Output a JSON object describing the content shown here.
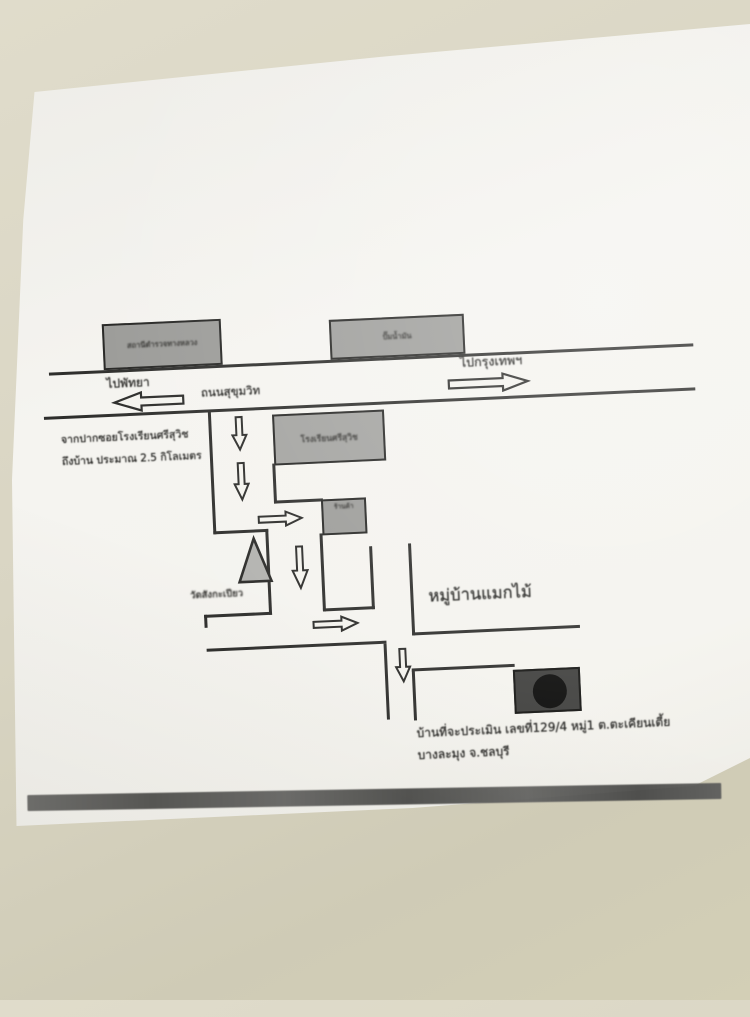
{
  "photo": {
    "surface": "desk",
    "background_color": "#d9d5c3",
    "paper_color": "#f4f3ee",
    "ink_color": "#2e2e2c"
  },
  "map": {
    "kind": "hand-drawn directions sketch (Thai)",
    "road": {
      "name_label": "ถนนสุขุมวิท",
      "left_direction_label": "ไปพัทยา",
      "right_direction_label": "ไปกรุงเทพฯ"
    },
    "buildings": [
      {
        "label": "สถานีตำรวจทางหลวง"
      },
      {
        "label": "ปั๊มน้ำมัน"
      }
    ],
    "school_label": "โรงเรียนศรีสุวิช",
    "shop_label": "ร้านค้า",
    "temple_label": "วัดสังกะเปียว",
    "village_label": "หมู่บ้านแมกไม้",
    "note_lines": [
      "จากปากซอยโรงเรียนศรีสุวิช",
      "ถึงบ้าน ประมาณ 2.5 กิโลเมตร"
    ],
    "address_lines": [
      "บ้านที่จะประเมิน เลขที่129/4 หมู่1 ต.ตะเคียนเตี้ย",
      "บางละมุง จ.ชลบุรี"
    ],
    "destination_marker": "black box with filled circle",
    "distance_km": "2.5"
  }
}
